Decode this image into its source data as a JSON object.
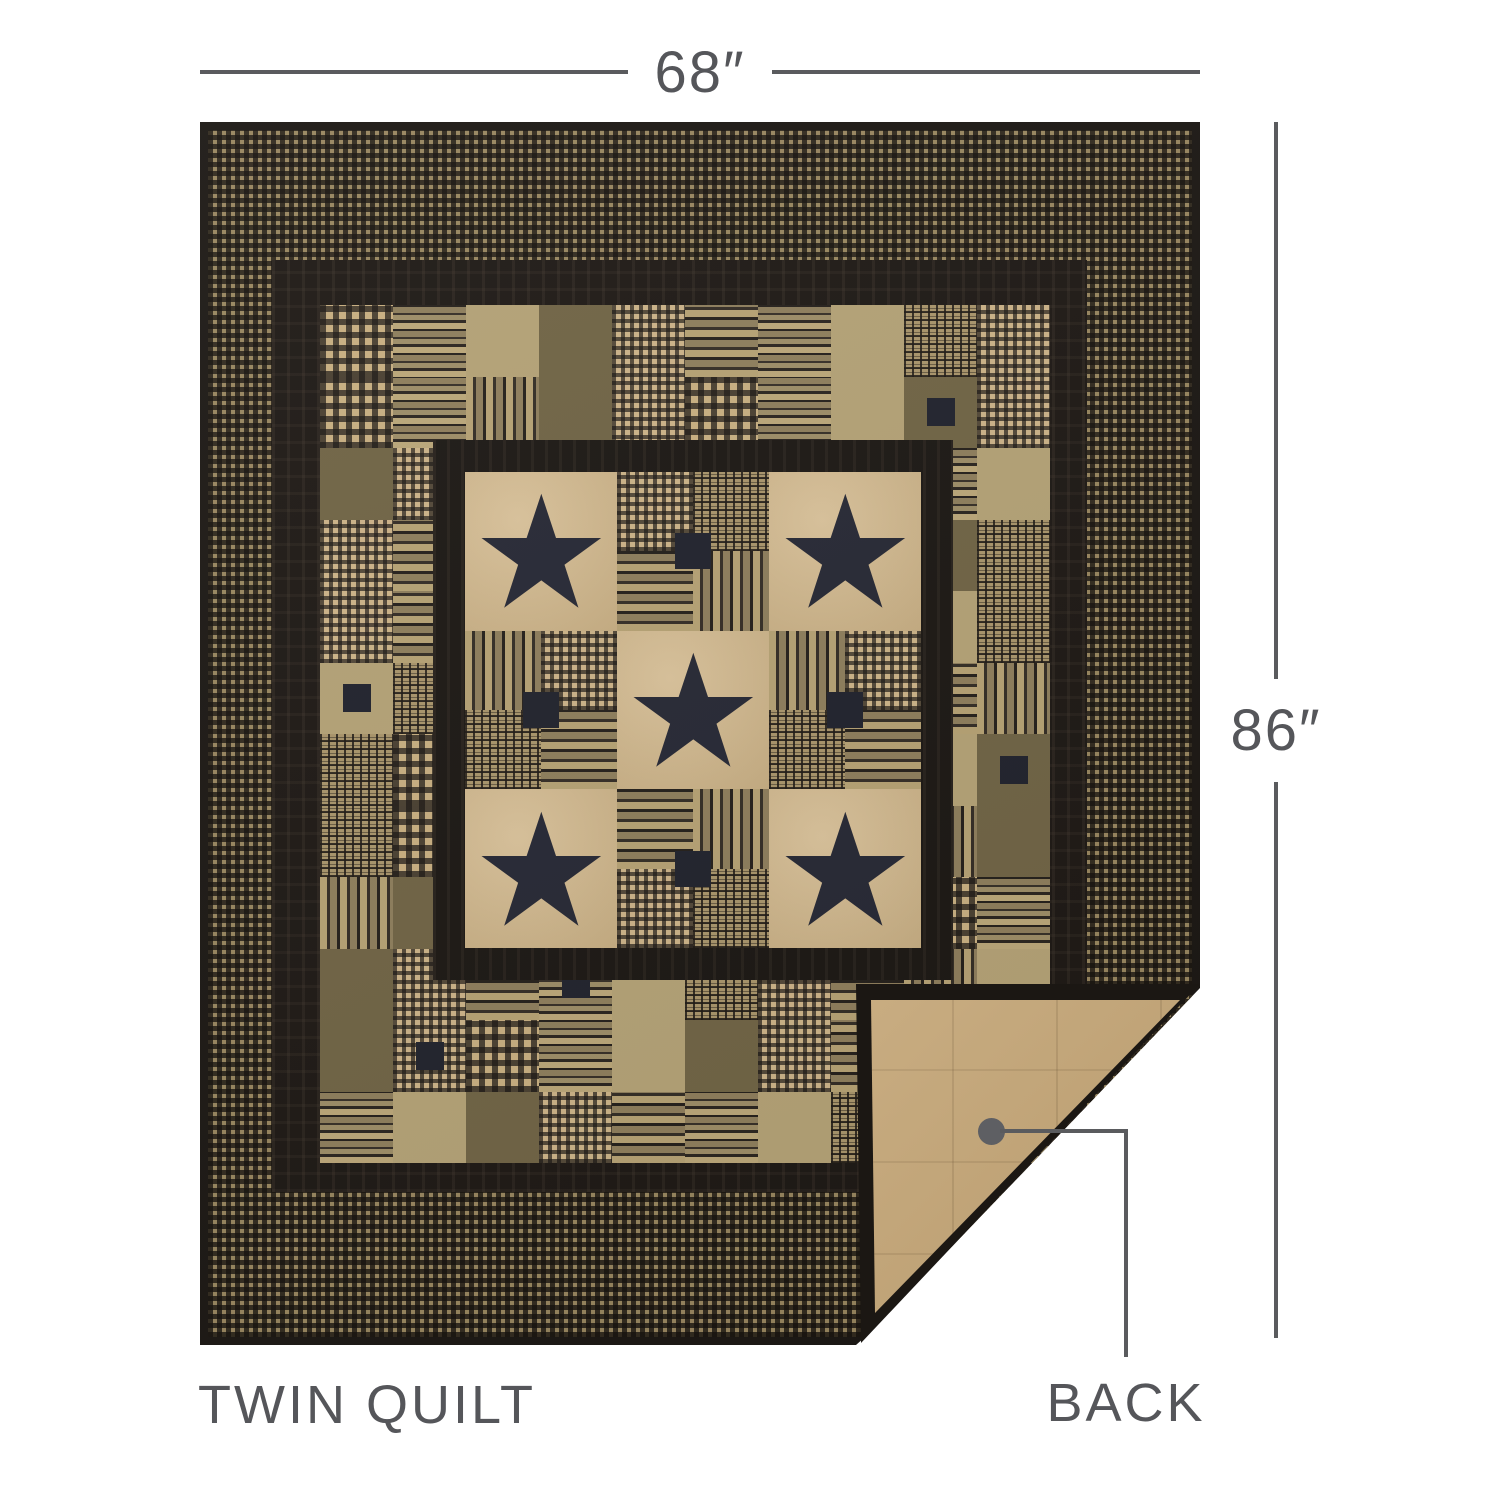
{
  "annotations": {
    "width_label": "68″",
    "height_label": "86″",
    "product_label": "TWIN QUILT",
    "back_label": "BACK"
  },
  "colors": {
    "annotation_text": "#55565a",
    "dimension_line": "#5a5b5e",
    "binding_black": "#1b1713",
    "ruffle_black": "#1d1814",
    "star_navy": "#262834",
    "star_block_tan": "#d3b88a",
    "quilt_back_tan": "#c3a474",
    "border_plaid_base": "#97855e",
    "check_tan": "#c7ae80"
  },
  "quilt": {
    "center_grid": {
      "rows": 3,
      "cols": 3,
      "star_cells": [
        [
          0,
          0
        ],
        [
          0,
          2
        ],
        [
          1,
          1
        ],
        [
          2,
          0
        ],
        [
          2,
          2
        ]
      ],
      "patch_quadrant_fabrics": [
        "f-hstripe",
        "f-vstripe",
        "f-check2",
        "f-plaid"
      ]
    },
    "patch_field": {
      "cols": 10,
      "rows": 12,
      "fabrics": [
        "f-check",
        "f-vstripe",
        "f-plaid",
        "f-hstripe",
        "f-solid",
        "f-check2",
        "f-hstripe2",
        "f-olive"
      ]
    },
    "star_points": "50,4 61.8,39.5 98,39.5 68.6,61 79.8,95.5 50,73.5 20.2,95.5 31.4,61 2,39.5 38.2,39.5"
  }
}
